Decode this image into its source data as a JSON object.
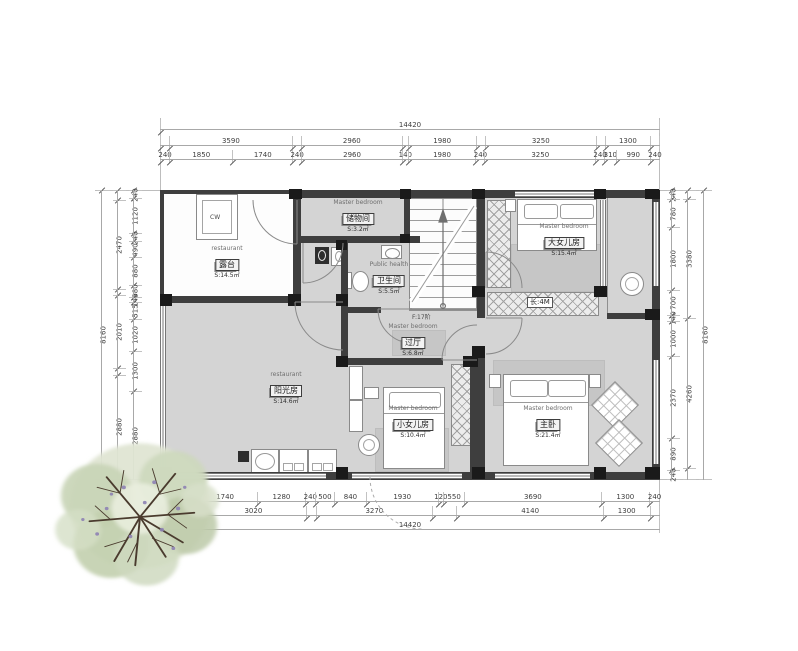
{
  "plan_title": "second-floor-plan",
  "colors": {
    "wall": "#3e3e3e",
    "column": "#1a1a1a",
    "floor": "#d4d4d4",
    "rug": "#c6c6c6",
    "outline": "#8a8a8a",
    "dim_text": "#3d3d3d",
    "tree_foliage": "#c6d2b4",
    "tree_branch": "#4a3b2e"
  },
  "rooms": [
    {
      "id": "storage",
      "en": "Master bedroom",
      "zh": "储物间",
      "area": "S:3.2㎡",
      "x": 358,
      "y": 216
    },
    {
      "id": "terrace",
      "en": "restaurant",
      "zh": "露台",
      "area": "S:14.5㎡",
      "x": 227,
      "y": 262
    },
    {
      "id": "bathroom",
      "en": "Public health",
      "zh": "卫生间",
      "area": "S:5.5㎡",
      "x": 389,
      "y": 278
    },
    {
      "id": "hallway",
      "en": "Master bedroom",
      "zh": "过厅",
      "area": "S:6.8㎡",
      "x": 413,
      "y": 340
    },
    {
      "id": "sunroom",
      "en": "restaurant",
      "zh": "阳光房",
      "area": "S:14.6㎡",
      "x": 286,
      "y": 388
    },
    {
      "id": "little-daughter",
      "en": "Master bedroom",
      "zh": "小女儿房",
      "area": "S:10.4㎡",
      "x": 413,
      "y": 422
    },
    {
      "id": "master-bedroom",
      "en": "Master bedroom",
      "zh": "主卧",
      "area": "S:21.4㎡",
      "x": 548,
      "y": 422
    },
    {
      "id": "elder-daughter",
      "en": "Master bedroom",
      "zh": "大女儿房",
      "area": "S:15.4㎡",
      "x": 564,
      "y": 240
    }
  ],
  "labels": {
    "closet": "长:4M",
    "stair": "F:17阶",
    "terrace_window": "CW"
  },
  "dimensions": {
    "top": {
      "total": [
        {
          "v": 14420,
          "t": "14420"
        }
      ],
      "groups": [
        {
          "v": 240,
          "t": ""
        },
        {
          "v": 3590,
          "t": "3590"
        },
        {
          "v": 240,
          "t": ""
        },
        {
          "v": 2960,
          "t": "2960"
        },
        {
          "v": 140,
          "t": ""
        },
        {
          "v": 1980,
          "t": "1980"
        },
        {
          "v": 240,
          "t": ""
        },
        {
          "v": 3250,
          "t": "3250"
        },
        {
          "v": 240,
          "t": ""
        },
        {
          "v": 1300,
          "t": "1300"
        },
        {
          "v": 240,
          "t": ""
        }
      ],
      "details": [
        {
          "v": 240,
          "t": "240"
        },
        {
          "v": 1850,
          "t": "1850"
        },
        {
          "v": 1740,
          "t": "1740"
        },
        {
          "v": 240,
          "t": "240"
        },
        {
          "v": 2960,
          "t": "2960"
        },
        {
          "v": 140,
          "t": "140"
        },
        {
          "v": 1980,
          "t": "1980"
        },
        {
          "v": 240,
          "t": "240"
        },
        {
          "v": 3250,
          "t": "3250"
        },
        {
          "v": 240,
          "t": "240"
        },
        {
          "v": 310,
          "t": "310"
        },
        {
          "v": 990,
          "t": "990"
        },
        {
          "v": 240,
          "t": "240"
        }
      ]
    },
    "bottom": {
      "details": [
        {
          "v": 850,
          "t": "850"
        },
        {
          "v": 1740,
          "t": "1740"
        },
        {
          "v": 1280,
          "t": "1280"
        },
        {
          "v": 240,
          "t": "240"
        },
        {
          "v": 500,
          "t": "500"
        },
        {
          "v": 840,
          "t": "840"
        },
        {
          "v": 1930,
          "t": "1930"
        },
        {
          "v": 120,
          "t": "120"
        },
        {
          "v": 550,
          "t": "550"
        },
        {
          "v": 3690,
          "t": "3690"
        },
        {
          "v": 1300,
          "t": "1300"
        },
        {
          "v": 240,
          "t": "240"
        }
      ],
      "groups": [
        {
          "v": 1090,
          "t": ""
        },
        {
          "v": 3020,
          "t": "3020"
        },
        {
          "v": 240,
          "t": ""
        },
        {
          "v": 3270,
          "t": "3270"
        },
        {
          "v": 670,
          "t": ""
        },
        {
          "v": 4140,
          "t": "4140"
        },
        {
          "v": 1300,
          "t": "1300"
        },
        {
          "v": 240,
          "t": ""
        }
      ],
      "total": [
        {
          "v": 14420,
          "t": "14420"
        }
      ]
    },
    "left": {
      "details": [
        {
          "v": 240,
          "t": "240"
        },
        {
          "v": 1120,
          "t": "1120"
        },
        {
          "v": 240,
          "t": "240"
        },
        {
          "v": 490,
          "t": "490"
        },
        {
          "v": 880,
          "t": "880"
        },
        {
          "v": 380,
          "t": "380"
        },
        {
          "v": 140,
          "t": "140"
        },
        {
          "v": 515,
          "t": "515"
        },
        {
          "v": 1020,
          "t": "1020"
        },
        {
          "v": 1300,
          "t": "1300"
        },
        {
          "v": 2880,
          "t": "2880"
        }
      ],
      "groups": [
        {
          "v": 240,
          "t": ""
        },
        {
          "v": 2470,
          "t": "2470"
        },
        {
          "v": 140,
          "t": ""
        },
        {
          "v": 2010,
          "t": "2010"
        },
        {
          "v": 150,
          "t": ""
        },
        {
          "v": 2880,
          "t": "2880"
        }
      ],
      "total": [
        {
          "v": 8160,
          "t": "8160"
        }
      ]
    },
    "right": {
      "details": [
        {
          "v": 240,
          "t": "240"
        },
        {
          "v": 780,
          "t": "780"
        },
        {
          "v": 1800,
          "t": "1800"
        },
        {
          "v": 700,
          "t": "700"
        },
        {
          "v": 140,
          "t": "140"
        },
        {
          "v": 1000,
          "t": "1000"
        },
        {
          "v": 2370,
          "t": "2370"
        },
        {
          "v": 890,
          "t": "890"
        },
        {
          "v": 240,
          "t": "240"
        }
      ],
      "groups": [
        {
          "v": 240,
          "t": ""
        },
        {
          "v": 3380,
          "t": "3380"
        },
        {
          "v": 4260,
          "t": "4260"
        },
        {
          "v": 280,
          "t": ""
        }
      ],
      "total": [
        {
          "v": 8160,
          "t": "8160"
        }
      ]
    }
  }
}
